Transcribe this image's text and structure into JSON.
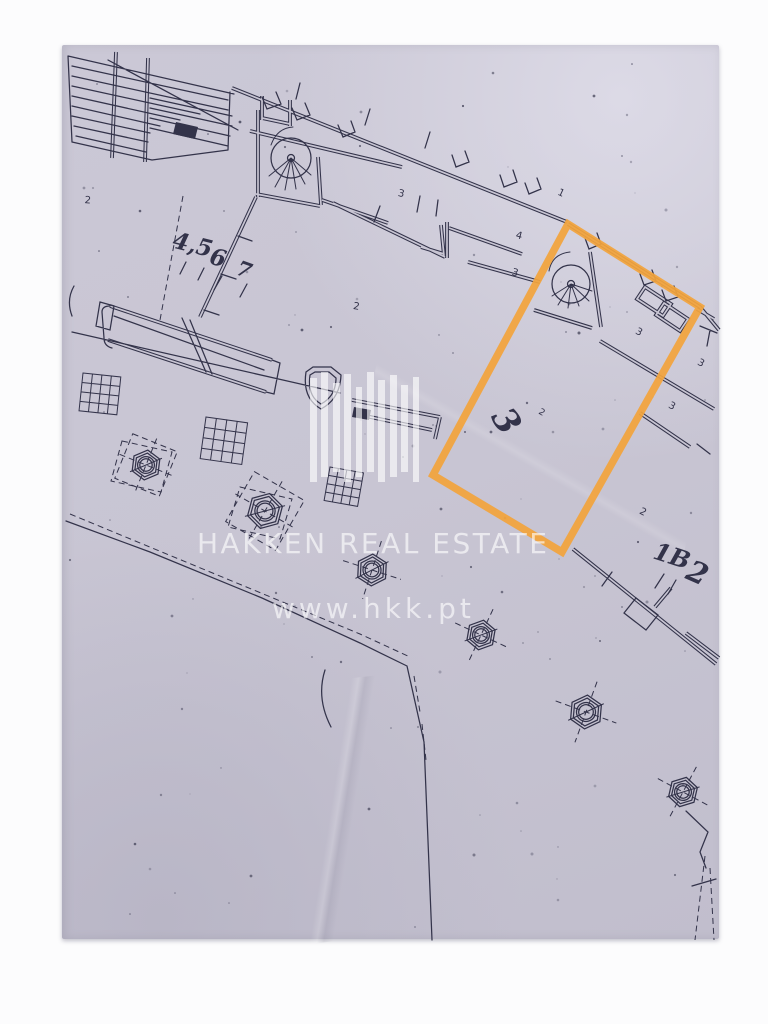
{
  "colors": {
    "paper": "#c8c5d3",
    "ink": "#33334a",
    "accent": "#f2a43c",
    "background": "#fcfcfd",
    "watermark": "rgba(255,255,255,0.62)"
  },
  "watermark": {
    "brand": "HAKKEN REAL ESTATE",
    "website": "www.hkk.pt"
  },
  "highlighted_unit": {
    "number": "3",
    "outline_color": "#f2a43c"
  },
  "labels": {
    "handwritten": {
      "units_45": "4,5",
      "units_6": "6",
      "units_7": "7",
      "unit_3_big": "3",
      "unit_1b": "1B",
      "unit_2_big": "2"
    },
    "printed": {
      "tl_2": "2",
      "corridor_3": "3",
      "corridor_1": "1",
      "unit_4": "4",
      "unit_3a": "3",
      "inner_2": "2",
      "near3_2": "2",
      "right_3a": "3",
      "right_3b": "3",
      "right_3c": "3",
      "right_2": "2"
    }
  }
}
